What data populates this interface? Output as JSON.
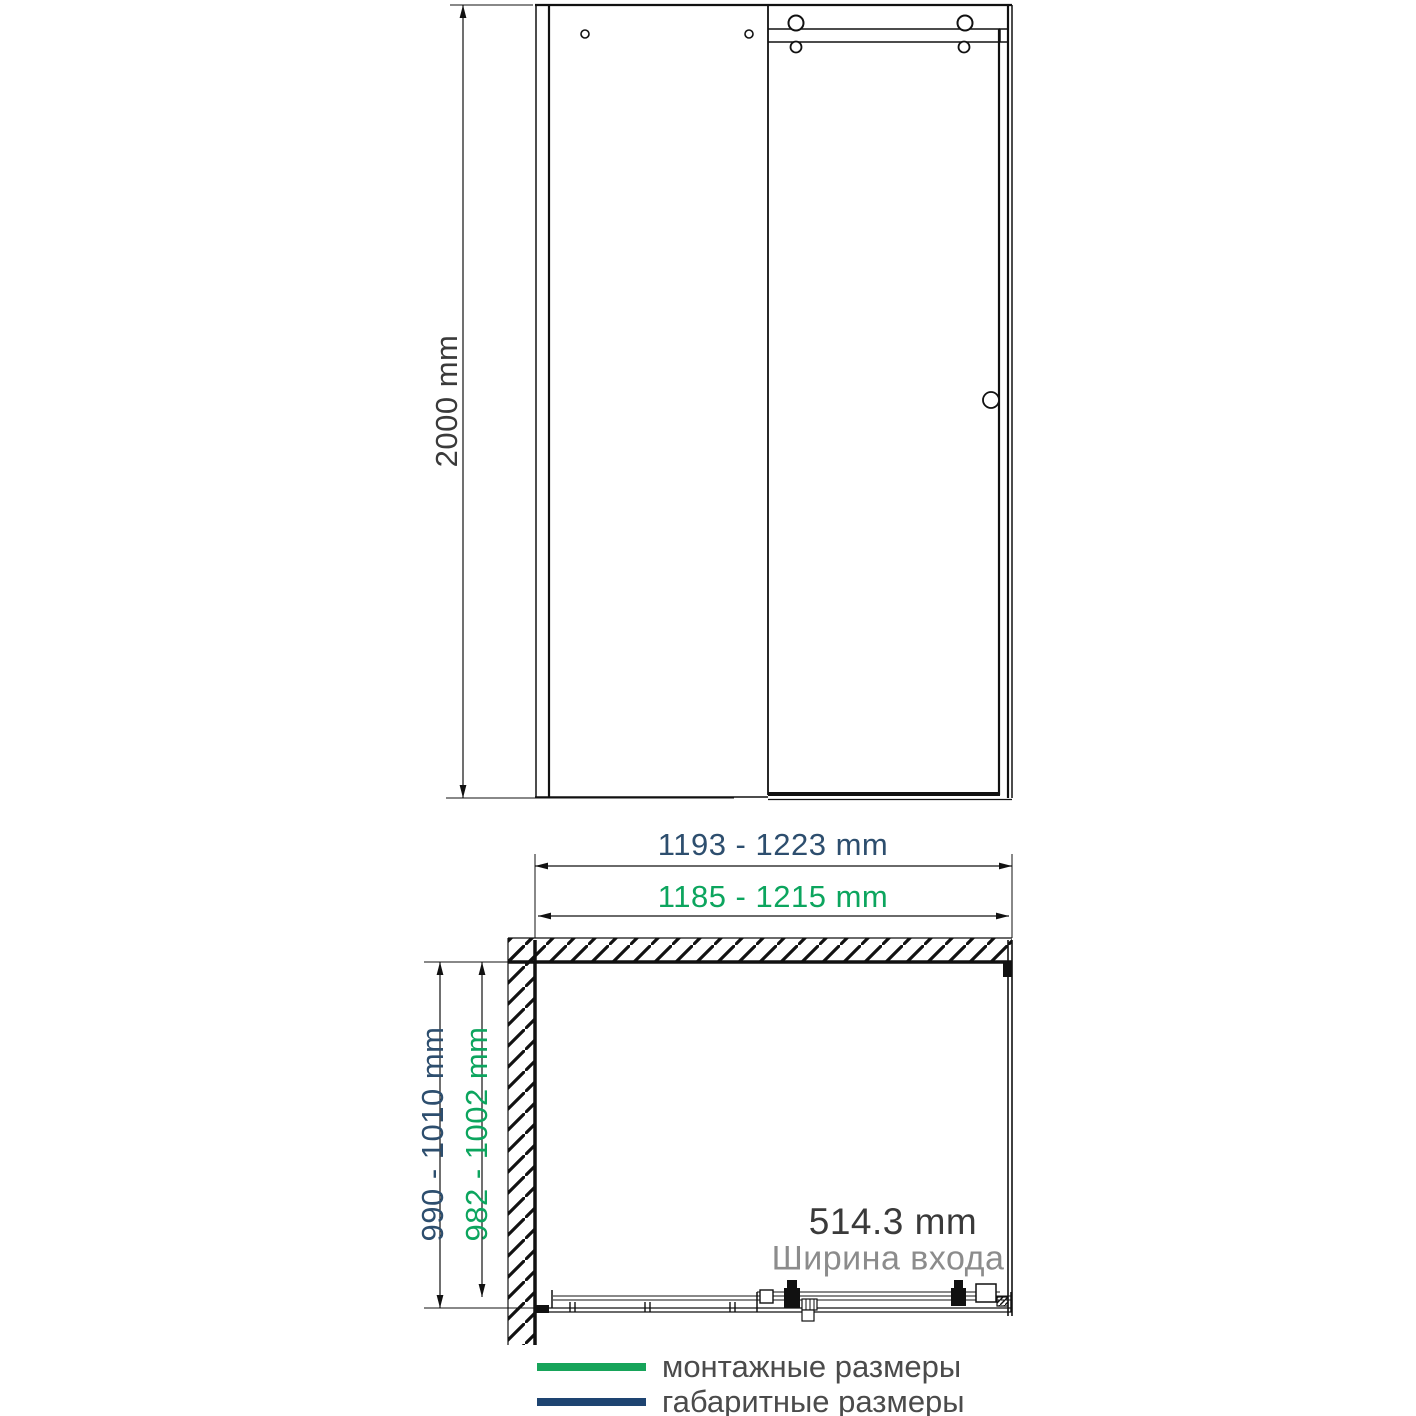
{
  "colors": {
    "line": "#111111",
    "mounting_green_line": "#17a45a",
    "overall_blue_line": "#1e4471",
    "mounting_green_text": "#0ca55e",
    "overall_blue_text": "#2d4e6e",
    "dark_text": "#3a3a3a",
    "muted_text": "#8c8c8c",
    "legend_text": "#4b4b4b"
  },
  "front_elevation": {
    "height_dimension_label": "2000 mm"
  },
  "plan_view": {
    "overall_width_label": "1193 - 1223 mm",
    "mounting_width_label": "1185 - 1215 mm",
    "overall_depth_label": "990 - 1010 mm",
    "mounting_depth_label": "982 - 1002 mm",
    "entrance_width_value": "514.3 mm",
    "entrance_width_caption": "Ширина входа"
  },
  "legend": {
    "items": [
      {
        "label": "монтажные размеры",
        "color": "#17a45a"
      },
      {
        "label": "габаритные размеры",
        "color": "#1e4471"
      }
    ]
  }
}
